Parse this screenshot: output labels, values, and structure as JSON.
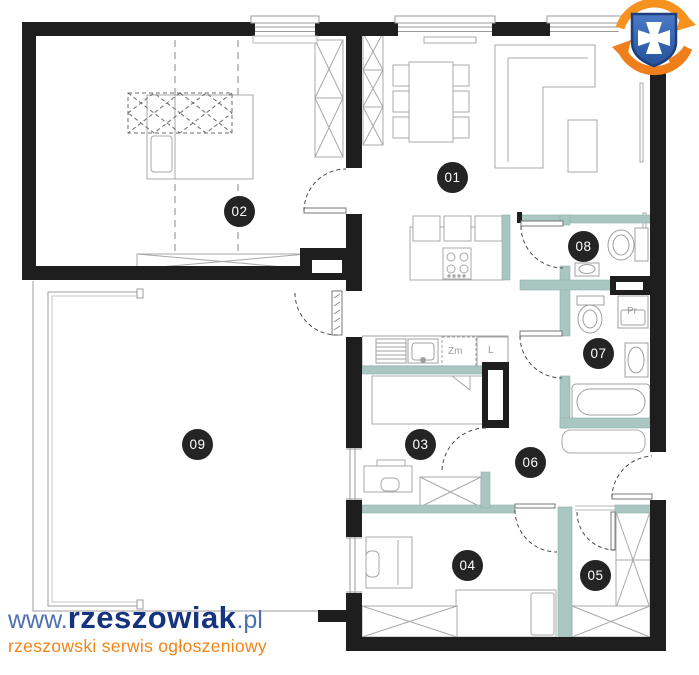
{
  "floor_plan": {
    "room_badges": [
      {
        "number": "01"
      },
      {
        "number": "02"
      },
      {
        "number": "03"
      },
      {
        "number": "04"
      },
      {
        "number": "05"
      },
      {
        "number": "06"
      },
      {
        "number": "07"
      },
      {
        "number": "08"
      },
      {
        "number": "09"
      }
    ],
    "appliance_labels": {
      "dishwasher": "Zm",
      "fridge": "L",
      "washing_machine": "Pr"
    },
    "colors": {
      "wall_black": "#1e1e1e",
      "partition_teal": "#a9c6c0",
      "furniture_gray": "#a8a8a8",
      "badge_background": "#242424",
      "badge_text": "#ffffff",
      "label_gray": "#9b9b9b"
    }
  },
  "watermark": {
    "url_prefix": "www.",
    "brand": "rzeszowiak",
    "url_suffix": ".pl",
    "tagline": "rzeszowski serwis ogłoszeniowy",
    "colors": {
      "url_blue": "#4e6fb0",
      "brand_navy": "#16337e",
      "tagline_orange": "#f08418"
    }
  },
  "logo": {
    "name": "rzeszowiak-emblem",
    "colors": {
      "shield_blue": "#2e62b1",
      "shield_border": "#1d3f7c",
      "cross": "#ffffff",
      "swirl_orange": "#f6921e"
    }
  }
}
